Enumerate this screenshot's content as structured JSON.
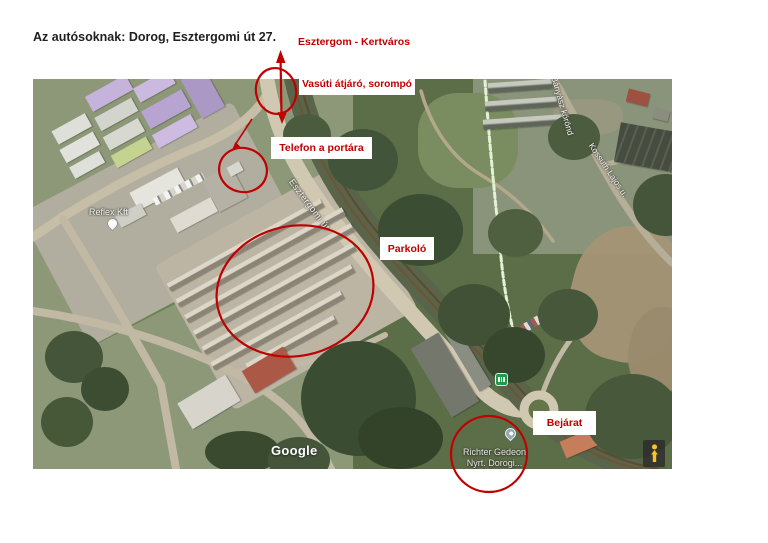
{
  "title": "Az autósoknak: Dorog, Esztergomi út 27.",
  "annotations": {
    "accent_color": "#c00000",
    "destination_label": "Esztergom - Kertváros",
    "rail_crossing_label": "Vasúti átjáró, sorompó",
    "phone_label": "Telefon a portára",
    "parking_label": "Parkoló",
    "entrance_label": "Bejárat"
  },
  "map": {
    "company_label": "Reflex Kft",
    "road_label": "Esztergomi út",
    "street_label_1": "Bányász körönd",
    "street_label_2": "Kossuth Lajos u.",
    "place_label_line1": "Richter Gedeon",
    "place_label_line2": "Nyrt. Dorogi...",
    "watermark": "Google",
    "icons": {
      "pegman": "pegman-icon",
      "transit": "transit-station-icon",
      "place_pin": "place-pin-icon",
      "company_pin": "company-pin-icon"
    }
  }
}
